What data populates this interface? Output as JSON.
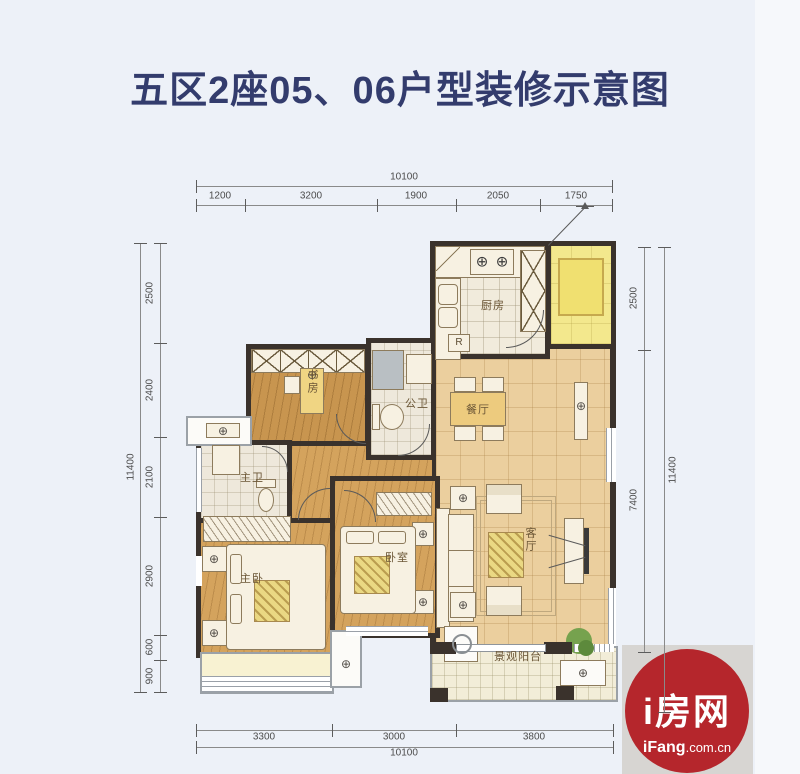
{
  "title": "五区2座05、06户型装修示意图",
  "floorplan": {
    "dims": {
      "top": {
        "overall": "10100",
        "segments": [
          "1200",
          "3200",
          "1900",
          "2050",
          "1750"
        ]
      },
      "bottom": {
        "overall": "10100",
        "segments": [
          "3300",
          "3000",
          "3800"
        ]
      },
      "left": {
        "overall": "11400",
        "segments": [
          "2500",
          "2400",
          "2100",
          "2900",
          "600",
          "900"
        ]
      },
      "right": {
        "overall": "11400",
        "segments": [
          "2500",
          "7400"
        ]
      }
    },
    "rooms": {
      "kitchen": "厨房",
      "dining": "餐厅",
      "living": "客厅",
      "study": "书房",
      "public_bath": "公卫",
      "master_bath": "主卫",
      "master_bedroom": "主卧",
      "bedroom": "卧室",
      "balcony": "景观阳台",
      "fridge_mark": "R"
    }
  },
  "logo": {
    "name": "i房网",
    "domain_bold": "iFang",
    "domain_rest": ".com.cn"
  },
  "colors": {
    "title_navy": "#333c6d",
    "wall": "#3a322c",
    "logo_red": "#b5262c",
    "background": "#edf1f8"
  }
}
